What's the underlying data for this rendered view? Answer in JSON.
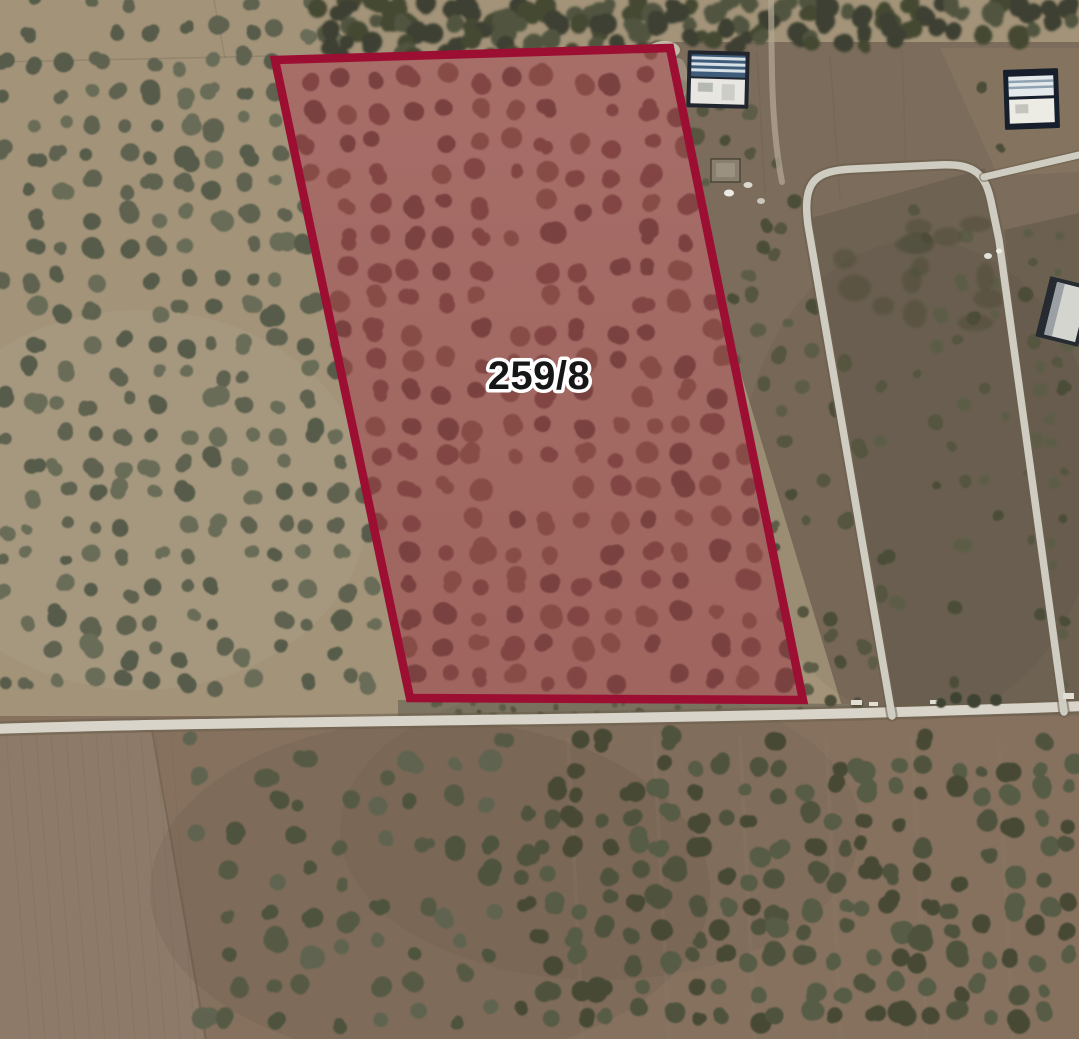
{
  "map": {
    "type": "satellite-parcel-view",
    "parcel": {
      "label": "259/8",
      "points": "275,60 670,48 803,700 410,698",
      "outline_color": "#9c0f33",
      "outline_width": 8.5,
      "ground_top": "#a5766e",
      "ground_bottom": "#9c6c62",
      "tint": "rgba(186,40,60,0.10)",
      "tree_colors": [
        "#7b4a44",
        "#724440",
        "#83514a"
      ],
      "label_x": 539,
      "label_y": 389,
      "label_size": 40,
      "label_fill": "#161616",
      "label_halo": "#ffffff"
    },
    "terrain": {
      "base": "#a29379",
      "right_field": "#7b6c5b",
      "loop_interior": "#6e6253",
      "right_strip": "#6c6051",
      "bottom": "#85715e",
      "bottom_field": "#8e7a69",
      "scrub_strip": "#7d7561",
      "top_right_field": "#84735f",
      "road": "#d8d4c9",
      "road_minor": "#cfccc1",
      "road_casing": "#6b5e4d",
      "driveway": "#b1a591",
      "grove_trees": [
        "#5e6250",
        "#696c57",
        "#575b48"
      ],
      "canopy_trees": [
        "#454833",
        "#3d4130",
        "#515440"
      ],
      "scrub_trees": [
        "#54543f",
        "#5d5d47",
        "#4b4e39"
      ],
      "bottom_mid_trees": [
        "#565a44",
        "#4e523d",
        "#5f6350"
      ],
      "bottom_right_trees": [
        "#4f533d",
        "#575b45",
        "#464a35"
      ]
    }
  }
}
